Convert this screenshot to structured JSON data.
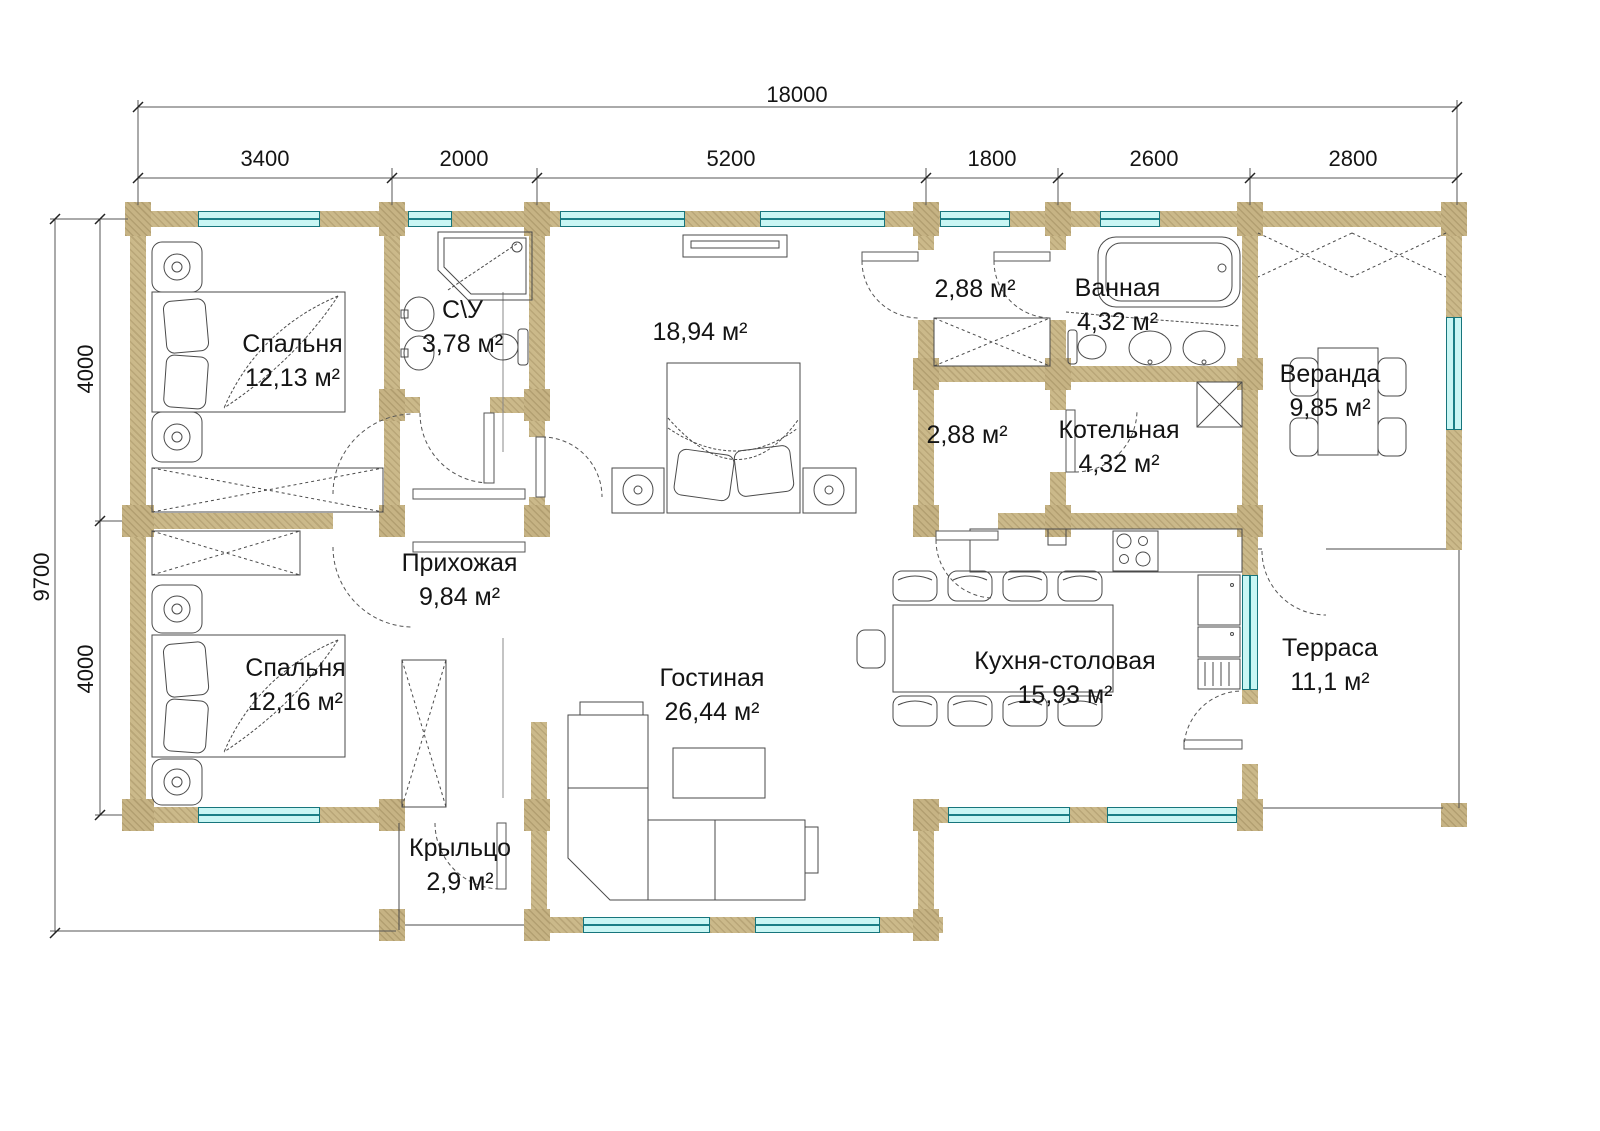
{
  "plan": {
    "dims": {
      "total_width": "18000",
      "top_chain": [
        "3400",
        "2000",
        "5200",
        "1800",
        "2600",
        "2800"
      ],
      "total_height": "9700",
      "left_chain": [
        "4000",
        "4000"
      ]
    },
    "rooms": {
      "bedroom1": {
        "name": "Спальня",
        "area": "12,13 м²"
      },
      "wc": {
        "name": "С\\У",
        "area": "3,78 м²"
      },
      "master": {
        "name": "",
        "area": "18,94 м²"
      },
      "hall_top": {
        "name": "",
        "area": "2,88 м²"
      },
      "bathroom": {
        "name": "Ванная",
        "area": "4,32 м²"
      },
      "veranda": {
        "name": "Веранда",
        "area": "9,85 м²"
      },
      "hall_bottom": {
        "name": "",
        "area": "2,88 м²"
      },
      "boiler": {
        "name": "Котельная",
        "area": "4,32 м²"
      },
      "entry": {
        "name": "Прихожая",
        "area": "9,84 м²"
      },
      "bedroom2": {
        "name": "Спальня",
        "area": "12,16 м²"
      },
      "living": {
        "name": "Гостиная",
        "area": "26,44 м²"
      },
      "kitchen": {
        "name": "Кухня-столовая",
        "area": "15,93 м²"
      },
      "terrace": {
        "name": "Терраса",
        "area": "11,1 м²"
      },
      "porch": {
        "name": "Крыльцо",
        "area": "2,9 м²"
      }
    },
    "colors": {
      "wall": "#CBB98A",
      "window_fill": "#C9F6F4",
      "window_stroke": "#17757C",
      "line": "#3C3C3C"
    }
  }
}
